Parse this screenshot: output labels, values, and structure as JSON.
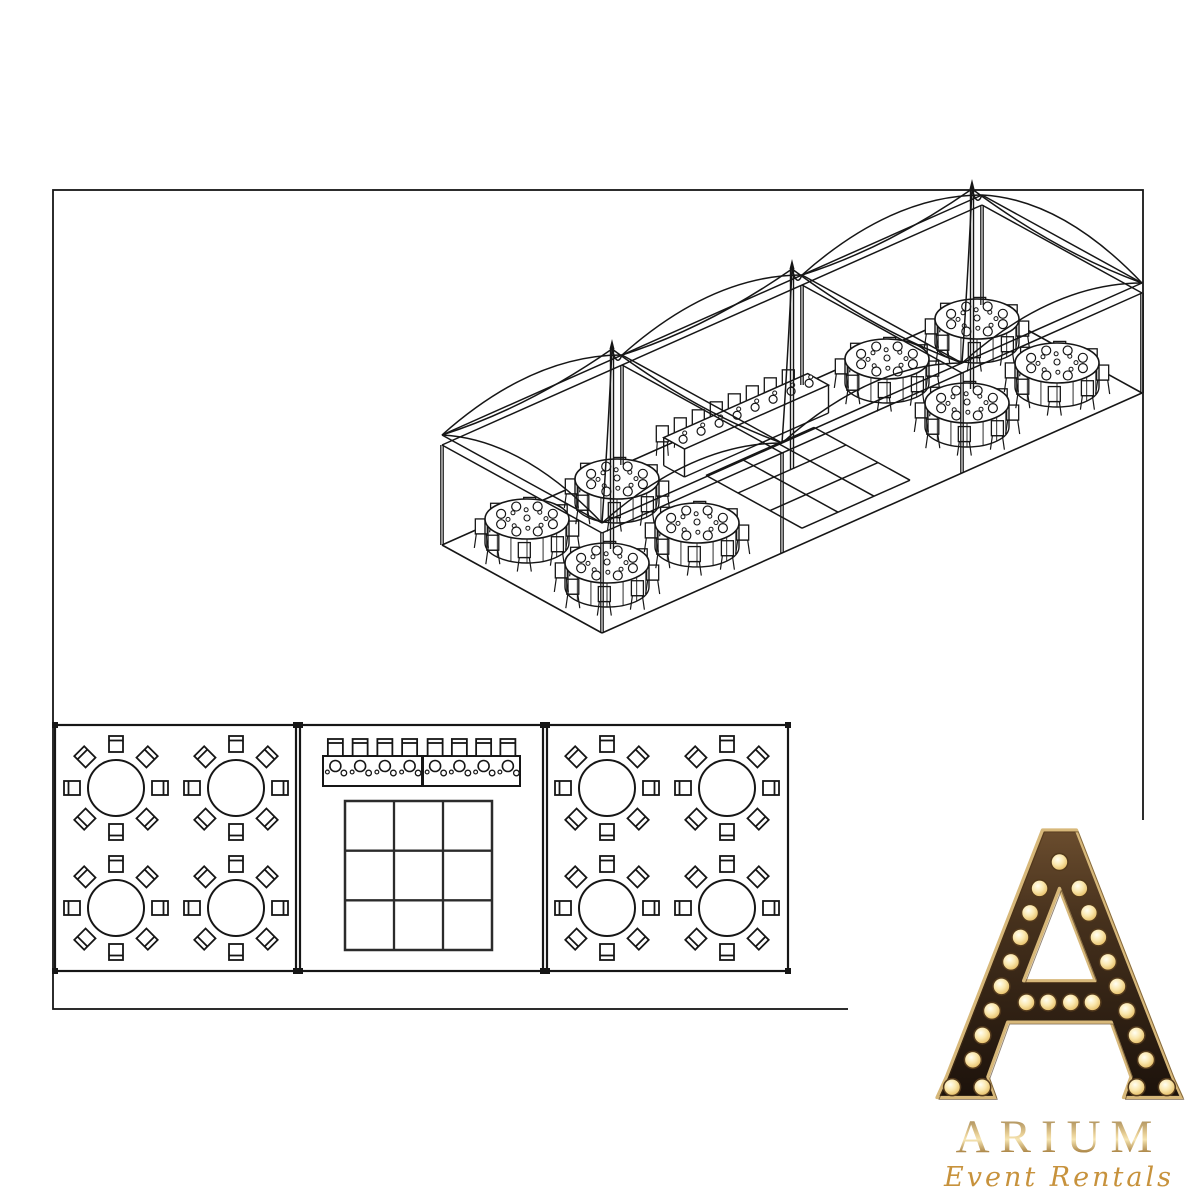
{
  "page": {
    "width": 1200,
    "height": 1200,
    "background": "#ffffff"
  },
  "frame": {
    "x": 53,
    "y": 190,
    "width": 1090,
    "height": 819,
    "stroke_color": "#161616"
  },
  "diagram": {
    "type": "event-tent-rental-layout",
    "views": [
      "isometric-tent-view",
      "floor-plan-view"
    ],
    "tent": {
      "sections": 3,
      "peaks": 3,
      "round_tables": 8,
      "seats_per_round_table": 8,
      "head_table_segments": 2,
      "head_table_seats": 8,
      "dance_floor_grid": "3x3"
    },
    "iso": {
      "ox": 442,
      "oy": 545,
      "lx": 9,
      "ly": -4,
      "dx": 8,
      "dy": 4.4,
      "eave_h": 100,
      "peak_h": 200,
      "table_top_h": 28,
      "table_rx": 42,
      "table_ry": 20,
      "table_positions_uv": [
        [
          5,
          5
        ],
        [
          15,
          5
        ],
        [
          5,
          15
        ],
        [
          15,
          15
        ],
        [
          45,
          5
        ],
        [
          55,
          5
        ],
        [
          45,
          15
        ],
        [
          55,
          15
        ]
      ],
      "head_table_uv": {
        "u1": 22.5,
        "u2": 38.5,
        "v1": 2.4,
        "v2": 5.0
      },
      "dance_floor_uv": {
        "u1": 24,
        "u2": 36,
        "v1": 6,
        "v2": 18,
        "cols": 3,
        "rows": 3
      }
    },
    "floor_plan": {
      "panels": [
        {
          "name": "left-dining-section",
          "x": 55,
          "y": 725,
          "w": 241,
          "h": 246
        },
        {
          "name": "center-section",
          "x": 300,
          "y": 725,
          "w": 243,
          "h": 246
        },
        {
          "name": "right-dining-section",
          "x": 547,
          "y": 725,
          "w": 241,
          "h": 246
        }
      ],
      "round_table_radius": 28,
      "chair": {
        "w": 14,
        "h": 16,
        "dist": 44
      },
      "left_tables": [
        [
          116,
          788
        ],
        [
          236,
          788
        ],
        [
          116,
          908
        ],
        [
          236,
          908
        ]
      ],
      "right_tables": [
        [
          607,
          788
        ],
        [
          727,
          788
        ],
        [
          607,
          908
        ],
        [
          727,
          908
        ]
      ],
      "head_tables": [
        {
          "x": 323,
          "y": 756,
          "w": 99,
          "h": 30
        },
        {
          "x": 423,
          "y": 756,
          "w": 97,
          "h": 30
        }
      ],
      "head_seats_per_table": 4,
      "dance_floor": {
        "x": 345,
        "y": 801,
        "w": 147,
        "h": 149,
        "cols": 3,
        "rows": 3
      }
    }
  },
  "logo": {
    "brand": "ARIUM",
    "tagline": "Event Rentals",
    "icon": "marquee-letter-A",
    "bulb_count": 25,
    "colors": {
      "gold_trim": "#d7b87a",
      "dark_brown": "#241812",
      "bulb_glow": "#f7e3a9",
      "brand_gold": "#c9a35c",
      "tagline_orange": "#c7923c"
    }
  }
}
